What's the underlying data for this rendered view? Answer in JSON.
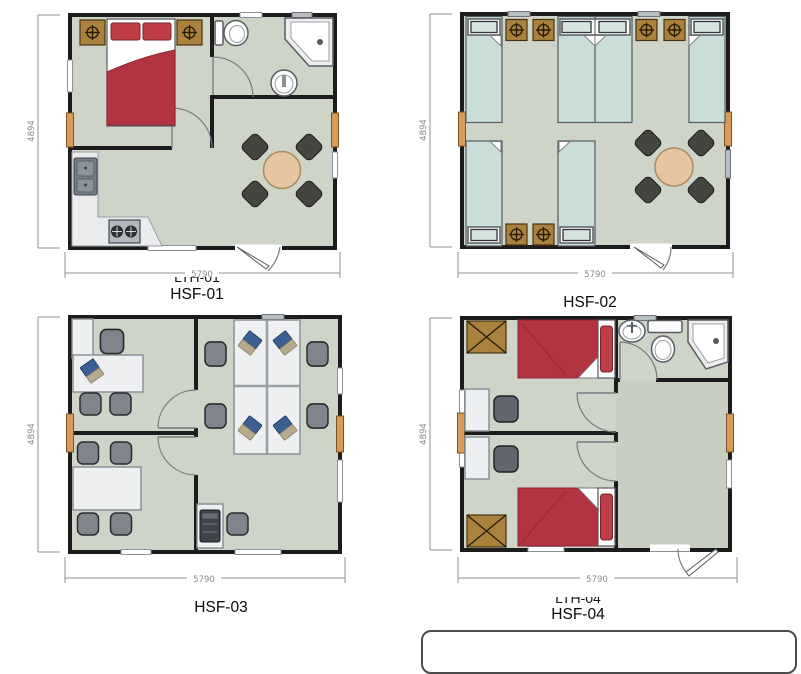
{
  "title": "Floor plan sheet with four modular unit layouts",
  "plans": [
    {
      "label": "HSF-01",
      "side_dim": "4894",
      "bottom_dim": "5790",
      "partial_label": "LTH-01"
    },
    {
      "label": "HSF-02",
      "side_dim": "4894",
      "bottom_dim": "5790"
    },
    {
      "label": "HSF-03",
      "side_dim": "4894",
      "bottom_dim": "5790"
    },
    {
      "label": "HSF-04",
      "side_dim": "4894",
      "bottom_dim": "5790",
      "partial_label": "LTH-04"
    }
  ],
  "colors": {
    "floor": "#cfd4c9",
    "floor_dark": "#c9cec3",
    "wall": "#1c1c1c",
    "bed_red": "#b23441",
    "bed_teal": "#c9ded9",
    "wood_brown": "#ab813e",
    "accent_orange": "#d99b57",
    "table_tan": "#e6c5a0",
    "dining_chair": "#45453f",
    "office_chair": "#81858b",
    "laptop_blue": "#3c5f93",
    "dimension_gray": "#8a8a8a"
  }
}
